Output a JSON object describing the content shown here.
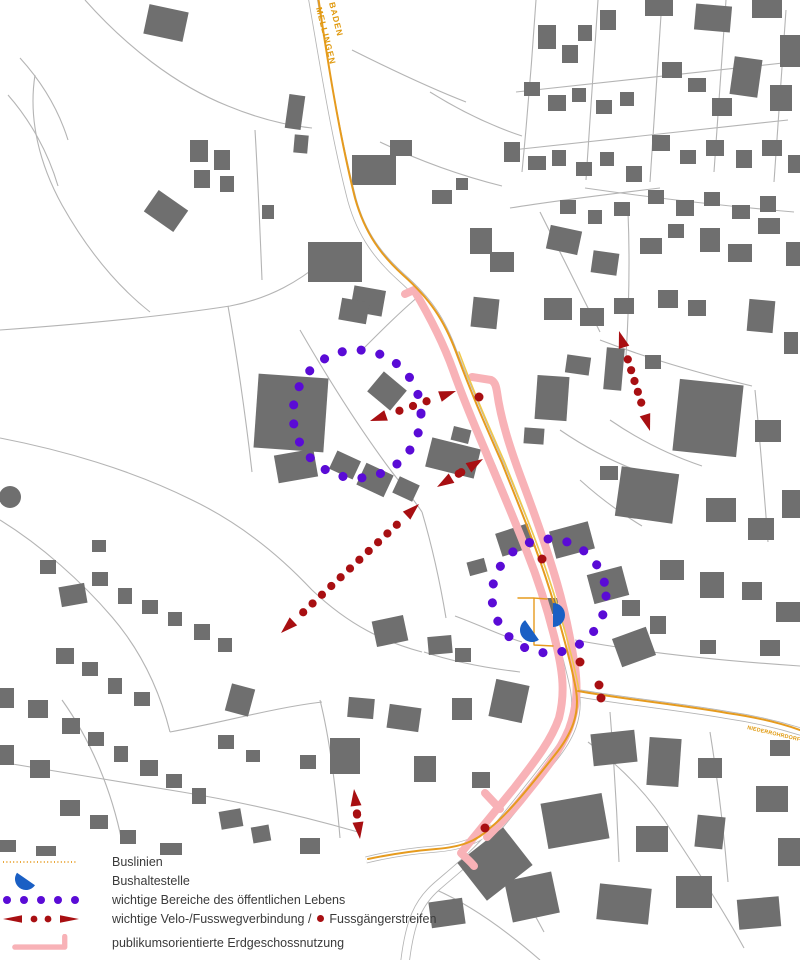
{
  "map": {
    "colors": {
      "building": "#6f6f6f",
      "road_line": "#b4b4b4",
      "bus_line": "#e69b1e",
      "bus_line2": "#f0c84a",
      "ground_floor": "#f8b2b7",
      "public_life": "#5a0bd6",
      "velo_route": "#a80f12",
      "bus_stop": "#1a5fc4",
      "label_orange": "#e09a10",
      "text": "#3a3a3a"
    },
    "labels": {
      "route_top_line1": "BADEN",
      "route_top_line2": "MELLINGEN",
      "route_east": "NIEDERROHRDORF"
    },
    "road_corridors": [
      {
        "d": "M312,-6 C322,50 334,130 352,200 C362,236 380,258 401,277 C428,301 441,320 453,353 C470,396 481,422 499,463 C521,516 537,553 553,607 C563,641 571,669 575,691 C579,717 570,737 552,759 C530,787 505,819 486,841 C470,859 452,873 436,887 C419,902 410,920 405,962",
        "w1": 9.5,
        "w2": 7.8
      },
      {
        "d": "M577,693 C622,701 682,707 727,715 C762,720 786,727 802,732",
        "w1": 8,
        "w2": 6.4
      },
      {
        "d": "M493,827 C479,841 460,847 436,849 C410,851 390,854 366,860",
        "w1": 7,
        "w2": 5.5
      }
    ],
    "road_lines": [
      "M85,0 C125,45 175,85 228,106 C262,120 292,126 312,128",
      "M35,75 C28,120 40,165 62,205 C84,244 112,282 150,312",
      "M20,58 C40,80 58,108 68,140",
      "M8,95 C30,120 48,152 58,186",
      "M0,330 C85,324 165,316 230,306 C272,298 300,280 322,262",
      "M228,306 C238,362 246,420 252,472",
      "M0,438 C62,450 132,470 192,500 C242,524 282,558 312,590 C350,626 385,642 422,652",
      "M0,520 C42,546 82,582 112,617 C142,652 160,692 170,732",
      "M170,732 C225,722 272,708 322,702",
      "M0,762 C60,772 122,782 182,792 C242,802 302,816 358,832",
      "M62,700 C92,742 112,792 122,842",
      "M300,330 C330,382 362,432 392,472 C406,490 414,500 422,512",
      "M422,512 C432,546 440,582 446,618",
      "M455,616 C482,626 502,636 522,642",
      "M424,652 C454,662 486,668 520,672",
      "M536,0 C532,60 527,120 522,172",
      "M598,0 C594,60 590,122 586,180",
      "M662,0 C658,60 654,120 650,182",
      "M726,0 C722,52 718,112 714,172",
      "M786,10 C782,62 778,122 774,182",
      "M516,92 C608,82 700,72 792,62",
      "M512,150 C604,140 696,130 788,120",
      "M510,208 C560,200 610,194 660,188",
      "M585,188 C654,198 724,206 794,212",
      "M540,212 C560,252 580,292 600,332",
      "M628,212 C630,260 629,308 626,356",
      "M600,340 C652,360 702,374 752,386",
      "M755,390 C760,440 764,490 768,542",
      "M610,420 C642,442 672,456 702,466",
      "M560,430 C592,452 622,466 652,476",
      "M580,480 C602,500 622,514 642,526",
      "M575,640 C640,652 710,660 800,666",
      "M588,742 C620,766 650,796 672,832 C696,868 722,908 744,948",
      "M710,732 C718,782 724,832 728,882",
      "M610,712 C614,762 617,812 619,862",
      "M432,888 C470,904 508,932 540,960",
      "M488,842 C510,872 528,902 544,932",
      "M352,50 C392,70 430,88 466,102",
      "M430,92 C462,112 492,126 522,136",
      "M380,142 C422,162 462,176 502,186",
      "M255,130 C258,180 260,230 262,280",
      "M320,700 C330,740 336,790 340,838",
      "M420,295 C400,312 382,330 364,348"
    ],
    "buildings": [
      [
        146,
        8,
        40,
        30,
        12
      ],
      [
        190,
        140,
        18,
        22,
        0
      ],
      [
        214,
        150,
        16,
        20,
        0
      ],
      [
        194,
        170,
        16,
        18,
        0
      ],
      [
        220,
        176,
        14,
        16,
        0
      ],
      [
        287,
        95,
        16,
        34,
        8
      ],
      [
        294,
        135,
        14,
        18,
        5
      ],
      [
        148,
        198,
        36,
        26,
        35
      ],
      [
        262,
        205,
        12,
        14,
        0
      ],
      [
        352,
        155,
        44,
        30,
        0
      ],
      [
        390,
        140,
        22,
        16,
        0
      ],
      [
        432,
        190,
        20,
        14,
        0
      ],
      [
        456,
        178,
        12,
        12,
        0
      ],
      [
        308,
        242,
        54,
        40,
        0
      ],
      [
        352,
        288,
        32,
        26,
        10
      ],
      [
        470,
        228,
        22,
        26,
        0
      ],
      [
        490,
        252,
        24,
        20,
        0
      ],
      [
        538,
        25,
        18,
        24,
        0
      ],
      [
        562,
        45,
        16,
        18,
        0
      ],
      [
        578,
        25,
        14,
        16,
        0
      ],
      [
        600,
        10,
        16,
        20,
        0
      ],
      [
        645,
        0,
        28,
        16,
        0
      ],
      [
        695,
        5,
        36,
        26,
        5
      ],
      [
        752,
        0,
        30,
        18,
        0
      ],
      [
        780,
        35,
        20,
        32,
        0
      ],
      [
        732,
        58,
        28,
        38,
        8
      ],
      [
        770,
        85,
        22,
        26,
        0
      ],
      [
        524,
        82,
        16,
        14,
        0
      ],
      [
        548,
        95,
        18,
        16,
        0
      ],
      [
        572,
        88,
        14,
        14,
        0
      ],
      [
        596,
        100,
        16,
        14,
        0
      ],
      [
        620,
        92,
        14,
        14,
        0
      ],
      [
        662,
        62,
        20,
        16,
        0
      ],
      [
        688,
        78,
        18,
        14,
        0
      ],
      [
        712,
        98,
        20,
        18,
        0
      ],
      [
        504,
        142,
        16,
        20,
        0
      ],
      [
        528,
        156,
        18,
        14,
        0
      ],
      [
        552,
        150,
        14,
        16,
        0
      ],
      [
        576,
        162,
        16,
        14,
        0
      ],
      [
        600,
        152,
        14,
        14,
        0
      ],
      [
        626,
        166,
        16,
        16,
        0
      ],
      [
        652,
        135,
        18,
        16,
        0
      ],
      [
        680,
        150,
        16,
        14,
        0
      ],
      [
        706,
        140,
        18,
        16,
        0
      ],
      [
        736,
        150,
        16,
        18,
        0
      ],
      [
        762,
        140,
        20,
        16,
        0
      ],
      [
        788,
        155,
        12,
        18,
        0
      ],
      [
        648,
        190,
        16,
        14,
        0
      ],
      [
        676,
        200,
        18,
        16,
        0
      ],
      [
        704,
        192,
        16,
        14,
        0
      ],
      [
        732,
        205,
        18,
        14,
        0
      ],
      [
        760,
        196,
        16,
        16,
        0
      ],
      [
        560,
        200,
        16,
        14,
        0
      ],
      [
        588,
        210,
        14,
        14,
        0
      ],
      [
        614,
        202,
        16,
        14,
        0
      ],
      [
        548,
        228,
        32,
        24,
        12
      ],
      [
        592,
        252,
        26,
        22,
        8
      ],
      [
        640,
        238,
        22,
        16,
        0
      ],
      [
        668,
        224,
        16,
        14,
        0
      ],
      [
        700,
        228,
        20,
        24,
        0
      ],
      [
        728,
        244,
        24,
        18,
        0
      ],
      [
        758,
        218,
        22,
        16,
        0
      ],
      [
        786,
        242,
        14,
        24,
        0
      ],
      [
        544,
        298,
        28,
        22,
        0
      ],
      [
        580,
        308,
        24,
        18,
        0
      ],
      [
        614,
        298,
        20,
        16,
        0
      ],
      [
        658,
        290,
        20,
        18,
        0
      ],
      [
        688,
        300,
        18,
        16,
        0
      ],
      [
        748,
        300,
        26,
        32,
        5
      ],
      [
        784,
        332,
        14,
        22,
        0
      ],
      [
        605,
        348,
        18,
        42,
        5
      ],
      [
        645,
        355,
        16,
        14,
        0
      ],
      [
        676,
        382,
        64,
        72,
        6
      ],
      [
        755,
        420,
        26,
        22,
        0
      ],
      [
        256,
        376,
        70,
        74,
        4
      ],
      [
        276,
        452,
        40,
        28,
        -10
      ],
      [
        340,
        300,
        28,
        22,
        10
      ],
      [
        372,
        378,
        30,
        26,
        40
      ],
      [
        428,
        443,
        50,
        30,
        14
      ],
      [
        452,
        428,
        18,
        14,
        14
      ],
      [
        536,
        376,
        32,
        44,
        4
      ],
      [
        524,
        428,
        20,
        16,
        4
      ],
      [
        566,
        356,
        24,
        18,
        8
      ],
      [
        472,
        298,
        26,
        30,
        6
      ],
      [
        600,
        466,
        18,
        14,
        0
      ],
      [
        332,
        455,
        26,
        20,
        25
      ],
      [
        360,
        468,
        30,
        24,
        25
      ],
      [
        395,
        480,
        22,
        18,
        25
      ],
      [
        60,
        585,
        26,
        20,
        -10
      ],
      [
        92,
        572,
        16,
        14,
        0
      ],
      [
        118,
        588,
        14,
        16,
        0
      ],
      [
        142,
        600,
        16,
        14,
        0
      ],
      [
        168,
        612,
        14,
        14,
        0
      ],
      [
        194,
        624,
        16,
        16,
        0
      ],
      [
        218,
        638,
        14,
        14,
        0
      ],
      [
        56,
        648,
        18,
        16,
        0
      ],
      [
        82,
        662,
        16,
        14,
        0
      ],
      [
        108,
        678,
        14,
        16,
        0
      ],
      [
        134,
        692,
        16,
        14,
        0
      ],
      [
        28,
        700,
        20,
        18,
        0
      ],
      [
        0,
        688,
        14,
        20,
        0
      ],
      [
        228,
        686,
        24,
        28,
        15
      ],
      [
        92,
        540,
        14,
        12,
        0
      ],
      [
        40,
        560,
        16,
        14,
        0
      ],
      [
        62,
        718,
        18,
        16,
        0
      ],
      [
        88,
        732,
        16,
        14,
        0
      ],
      [
        114,
        746,
        14,
        16,
        0
      ],
      [
        30,
        760,
        20,
        18,
        0
      ],
      [
        0,
        745,
        14,
        20,
        0
      ],
      [
        140,
        760,
        18,
        16,
        0
      ],
      [
        166,
        774,
        16,
        14,
        0
      ],
      [
        192,
        788,
        14,
        16,
        0
      ],
      [
        60,
        800,
        20,
        16,
        0
      ],
      [
        90,
        815,
        18,
        14,
        0
      ],
      [
        120,
        830,
        16,
        14,
        0
      ],
      [
        220,
        810,
        22,
        18,
        -10
      ],
      [
        252,
        826,
        18,
        16,
        -10
      ],
      [
        300,
        838,
        20,
        16,
        0
      ],
      [
        0,
        840,
        16,
        12,
        0
      ],
      [
        36,
        846,
        20,
        10,
        0
      ],
      [
        160,
        843,
        22,
        12,
        0
      ],
      [
        330,
        738,
        30,
        36,
        0
      ],
      [
        300,
        755,
        16,
        14,
        0
      ],
      [
        218,
        735,
        16,
        14,
        0
      ],
      [
        246,
        750,
        14,
        12,
        0
      ],
      [
        374,
        618,
        32,
        26,
        -12
      ],
      [
        428,
        636,
        24,
        18,
        -5
      ],
      [
        348,
        698,
        26,
        20,
        5
      ],
      [
        388,
        706,
        32,
        24,
        8
      ],
      [
        414,
        756,
        22,
        26,
        0
      ],
      [
        452,
        698,
        20,
        22,
        0
      ],
      [
        492,
        682,
        34,
        38,
        12
      ],
      [
        455,
        648,
        16,
        14,
        0
      ],
      [
        472,
        772,
        18,
        16,
        0
      ],
      [
        466,
        840,
        58,
        48,
        -38
      ],
      [
        430,
        900,
        34,
        26,
        -8
      ],
      [
        508,
        876,
        48,
        42,
        -12
      ],
      [
        544,
        598,
        14,
        16,
        0
      ],
      [
        498,
        528,
        34,
        24,
        -18
      ],
      [
        552,
        526,
        40,
        28,
        -15
      ],
      [
        468,
        560,
        18,
        14,
        -15
      ],
      [
        590,
        570,
        36,
        30,
        -15
      ],
      [
        616,
        632,
        36,
        30,
        -20
      ],
      [
        592,
        732,
        44,
        32,
        -6
      ],
      [
        648,
        738,
        32,
        48,
        4
      ],
      [
        698,
        758,
        24,
        20,
        0
      ],
      [
        544,
        798,
        62,
        46,
        -10
      ],
      [
        636,
        826,
        32,
        26,
        0
      ],
      [
        696,
        816,
        28,
        32,
        6
      ],
      [
        756,
        786,
        32,
        26,
        0
      ],
      [
        778,
        838,
        22,
        28,
        0
      ],
      [
        598,
        886,
        52,
        36,
        6
      ],
      [
        676,
        876,
        36,
        32,
        0
      ],
      [
        738,
        898,
        42,
        30,
        -5
      ],
      [
        770,
        740,
        20,
        16,
        0
      ],
      [
        618,
        470,
        58,
        50,
        8
      ],
      [
        706,
        498,
        30,
        24,
        0
      ],
      [
        748,
        518,
        26,
        22,
        0
      ],
      [
        782,
        490,
        18,
        28,
        0
      ],
      [
        660,
        560,
        24,
        20,
        0
      ],
      [
        700,
        572,
        24,
        26,
        0
      ],
      [
        742,
        582,
        20,
        18,
        0
      ],
      [
        776,
        602,
        24,
        20,
        0
      ],
      [
        622,
        600,
        18,
        16,
        0
      ],
      [
        650,
        616,
        16,
        18,
        0
      ],
      [
        760,
        640,
        20,
        16,
        0
      ],
      [
        700,
        640,
        16,
        14,
        0
      ]
    ],
    "building_circles": [
      [
        10,
        497,
        11
      ]
    ],
    "ground_floor_bands": [
      "M405,294 L414,290 C430,317 443,342 453,370 C463,398 473,422 485,450 C499,484 513,516 527,552 C539,582 549,614 557,648 C563,674 565,694 559,718 C551,741 535,761 515,787 C497,809 479,831 461,853 C466,858 470,861 474,866",
      "M472,377 L491,380 C495,382 496,386 497,392 C501,421 511,451 523,483 C535,515 547,549 557,583 C565,611 571,641 575,667 C578,689 577,707 569,729 C559,753 543,773 525,795 C511,813 497,827 487,837",
      "M500,809 L485,793"
    ],
    "bus_paths": [
      {
        "d": "M459,352 C475,395 487,422 505,463 C526,516 542,553 558,607 C568,641 575,668 579,690",
        "w": 1.5,
        "c": "bus_line2"
      },
      {
        "d": "M318,-4 C326,50 338,130 355,198 C365,234 382,256 403,275 C430,299 444,320 456,352 C472,395 484,422 502,463 C523,516 539,553 555,607 C565,641 572,668 576,690 C580,714 572,734 554,756 C532,784 508,814 490,828 C476,842 460,847 436,849 C412,851 392,854 368,859",
        "w": 2,
        "c": "bus_line"
      },
      {
        "d": "M578,691 C622,699 682,705 727,713 C762,718 786,725 800,730",
        "w": 2,
        "c": "bus_line"
      },
      {
        "d": "M534,645 L534,598 L547,599 M534,598 L518,598 M534,645 L553,646",
        "w": 1.4,
        "c": "bus_line"
      }
    ],
    "life_circles": [
      [
        357,
        414,
        64
      ],
      [
        549,
        596,
        57
      ]
    ],
    "velo_arrows": [
      [
        370,
        421,
        456,
        391
      ],
      [
        437,
        487,
        483,
        459
      ],
      [
        281,
        633,
        419,
        504
      ],
      [
        619,
        331,
        650,
        431
      ],
      [
        354,
        789,
        360,
        839
      ]
    ],
    "crossings": [
      [
        479,
        397
      ],
      [
        542,
        559
      ],
      [
        580,
        662
      ],
      [
        599,
        685
      ],
      [
        601,
        698
      ],
      [
        485,
        828
      ]
    ],
    "bus_stops": [
      [
        553,
        615,
        90
      ],
      [
        532,
        630,
        235
      ]
    ]
  },
  "legend": {
    "items": [
      {
        "id": "buslinien",
        "label": "Buslinien"
      },
      {
        "id": "bushaltestelle",
        "label": "Bushaltestelle"
      },
      {
        "id": "bereiche",
        "label": "wichtige Bereiche des öffentlichen Lebens"
      },
      {
        "id": "velo",
        "label_pre": "wichtige Velo-/Fusswegverbindung /",
        "label_post": "Fussgängerstreifen"
      },
      {
        "id": "erdgeschoss",
        "label": "publikumsorientierte Erdgeschossnutzung"
      }
    ]
  }
}
